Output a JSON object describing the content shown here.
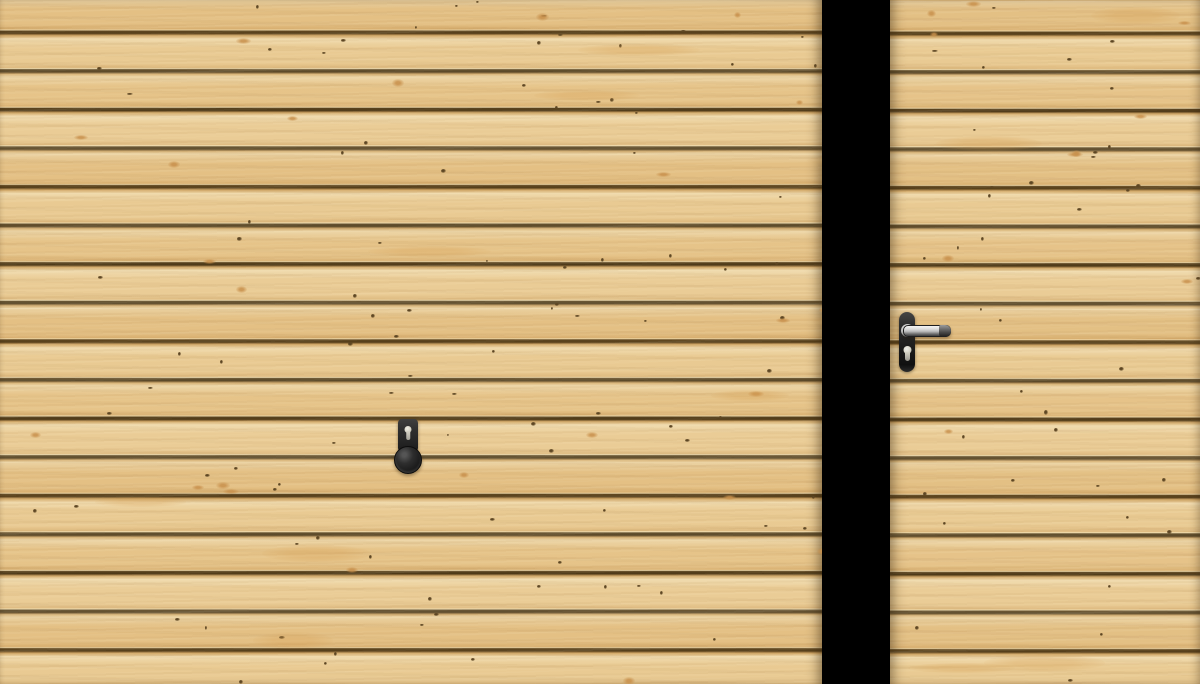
{
  "scene": {
    "background_color": "#000000"
  },
  "colors": {
    "gap_black": "#000000",
    "wood_base": "#e7c68c",
    "wood_light": "#eed8aa",
    "wood_dark": "#dab375",
    "wood_shadow": "#d4ad6e",
    "plank_gap": "#533f1d",
    "plank_gap_deep": "#473516",
    "plank_bevel": "#8a6b3b",
    "plank_bevel_hi": "#f0ddb0",
    "knot_dark": "#5d4623",
    "knot_orange": "#c8904c",
    "hardware_dark": "#1e1e1e",
    "hardware_plate": "#2e2e2e",
    "chrome_light": "#f0f0f0",
    "chrome_mid": "#b9b9b9",
    "chrome_dark": "#6e6e6e",
    "keyhole_metal": "#d6d3c6"
  },
  "left_door": {
    "kind": "garage-door-panel",
    "plank_rows": 18,
    "hardware": {
      "plate": "escutcheon-plate",
      "lock": "keyhole",
      "grip": "round-knob"
    }
  },
  "right_door": {
    "kind": "entry-door-panel",
    "plank_rows": 18,
    "hardware": {
      "plate": "backplate",
      "lock": "euro-cylinder",
      "grip": "lever-handle"
    }
  }
}
